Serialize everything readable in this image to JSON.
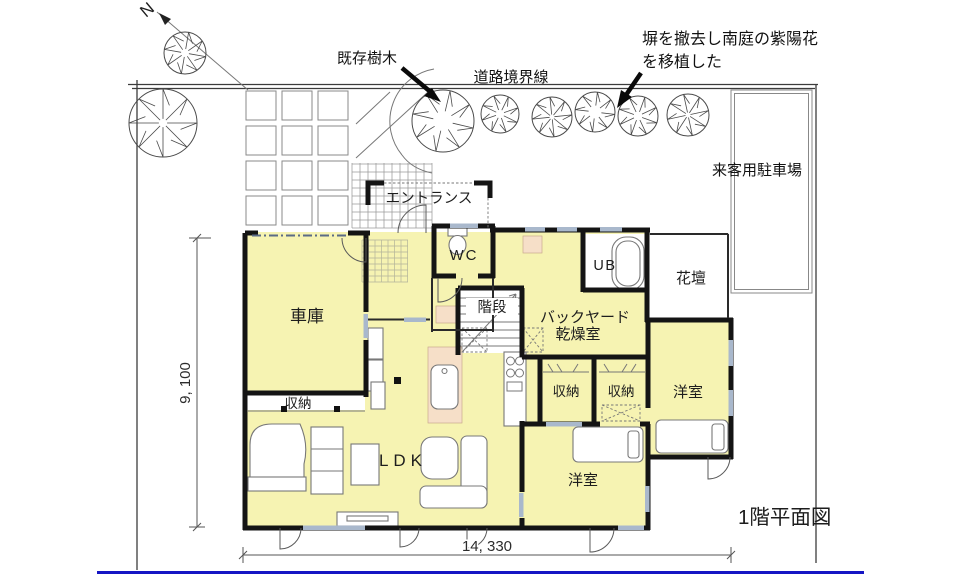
{
  "title": "1階平面図",
  "site": {
    "road_boundary_label": "道路境界線",
    "visitor_parking_label": "来客用駐車場",
    "north_label": "N"
  },
  "annotations": {
    "existing_tree": "既存樹木",
    "fence_note_line1": "塀を撤去し南庭の紫陽花",
    "fence_note_line2": "を移植した"
  },
  "rooms": {
    "entrance": "エントランス",
    "wc": "WC",
    "ub": "UB",
    "flower_bed": "花壇",
    "garage": "車庫",
    "stairs": "階段",
    "backyard_line1": "バックヤード",
    "backyard_line2": "乾燥室",
    "storage_left": "収納",
    "storage_center": "収納",
    "storage_right": "収納",
    "western_room_right": "洋室",
    "western_room_bottom": "洋室",
    "ldk": "LDK"
  },
  "dimensions": {
    "horizontal": "14, 330",
    "vertical": "9, 100"
  },
  "colors": {
    "room_fill": "#f6f3b2",
    "counter_fill": "#f6dfc8",
    "wall": "#141414",
    "footer_line": "#1515c4",
    "window_mark": "#a9b8cc"
  }
}
